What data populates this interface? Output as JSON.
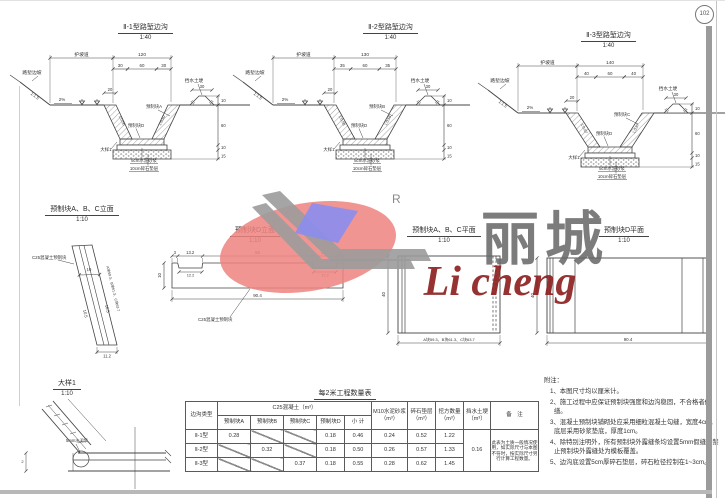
{
  "page": {
    "badge": "102"
  },
  "watermark": {
    "cn": "丽城",
    "en": "Li cheng",
    "r": "R"
  },
  "sections": {
    "s1": {
      "title": "Ⅱ-1型路堑边沟",
      "scale": "1:40",
      "total": "120",
      "sub": [
        "30",
        "60",
        "30"
      ],
      "berm": "护坡道",
      "cut": "路堑边坡",
      "slope": "1:1.5",
      "grade": "2%",
      "cap": "20",
      "slope_in": "1:0.50",
      "block_side": "预制块A",
      "block_bottom": "预制块D",
      "detail": "大样1",
      "mortar": "5cm水泥砂浆",
      "cushion": "10cm碎石垫层",
      "bank": "挡水土埂",
      "bank_w": "30",
      "bank_slope": "1:1",
      "vdims": [
        "10",
        "60",
        "10",
        "15"
      ]
    },
    "s2": {
      "title": "Ⅱ-2型路堑边沟",
      "scale": "1:40",
      "total": "130",
      "sub": [
        "35",
        "60",
        "35"
      ],
      "berm": "护坡道",
      "cut": "路堑边坡",
      "slope": "1:1.5",
      "grade": "2%",
      "cap": "20",
      "slope_in": "1:0.58",
      "block_side": "预制块B",
      "block_bottom": "预制块D",
      "detail": "大样1",
      "mortar": "5cm水泥砂浆",
      "cushion": "10cm碎石垫层",
      "bank": "挡水土埂",
      "bank_w": "30",
      "bank_slope": "1:1",
      "vdims": [
        "10",
        "60",
        "10",
        "15"
      ]
    },
    "s3": {
      "title": "Ⅱ-3型路堑边沟",
      "scale": "1:40",
      "total": "140",
      "sub": [
        "40",
        "60",
        "40"
      ],
      "berm": "护坡道",
      "cut": "路堑边坡",
      "slope": "1:1.5",
      "grade": "2%",
      "cap": "20",
      "slope_in": "1:0.67",
      "block_side": "预制块C",
      "block_bottom": "预制块D",
      "detail": "大样1",
      "mortar": "5cm水泥砂浆",
      "cushion": "10cm碎石垫层",
      "bank": "挡水土埂",
      "bank_w": "30",
      "bank_slope": "1:1",
      "vdims": [
        "10",
        "60",
        "10",
        "15"
      ]
    }
  },
  "elev_abc": {
    "title": "预制块A、B、C立面",
    "scale": "1:10",
    "material": "C25混凝土预制块",
    "dim_w": "10",
    "dim_s1": "10.5",
    "dim_s2": "10.5",
    "dim_b": "11.2",
    "lengths": "A块59.3、B块61.3、C块63.7"
  },
  "elev_d": {
    "title": "预制块D立面",
    "scale": "1:10",
    "material": "C25混凝土预制块",
    "dims_top": [
      "3",
      "13.2",
      "58",
      "13.2",
      "3"
    ],
    "dim_notch": "12.2",
    "dim_notch2": "12.2",
    "dim_small": "2",
    "dim_h": "10",
    "dim_b": "90.4"
  },
  "plan_abc": {
    "title": "预制块A、B、C平面",
    "scale": "1:10",
    "dim_h": "40",
    "dim_b": "A块59.3、B块61.3、C块63.7"
  },
  "plan_d": {
    "title": "预制块D平面",
    "scale": "1:10",
    "dim_h": "40",
    "dim_b": "90.4"
  },
  "detail1": {
    "title": "大样1",
    "scale": "1:10",
    "label": "5mm水泥浆",
    "dim": "2"
  },
  "table": {
    "title": "每2米工程数量表",
    "col_type": "边沟类型",
    "group_c25": "C25混凝土（m³）",
    "sub": [
      "预制块A",
      "预制块B",
      "预制块C",
      "预制块D",
      "小 计"
    ],
    "col_m10": "M10水泥砂浆",
    "col_m10_u": "（m³）",
    "col_cushion": "碎石垫层",
    "col_cushion_u": "（m³）",
    "col_excav": "挖方数量",
    "col_excav_u": "（m³）",
    "col_bank": "挡水土埂",
    "col_bank_u": "（m³）",
    "col_remark": "备　注",
    "rows": [
      {
        "type": "Ⅱ-1型",
        "a": "0.28",
        "b": "",
        "c": "",
        "d": "0.18",
        "sum": "0.46",
        "m10": "0.24",
        "cushion": "0.52",
        "excav": "1.22"
      },
      {
        "type": "Ⅱ-2型",
        "a": "",
        "b": "0.32",
        "c": "",
        "d": "0.18",
        "sum": "0.50",
        "m10": "0.26",
        "cushion": "0.57",
        "excav": "1.33"
      },
      {
        "type": "Ⅱ-3型",
        "a": "",
        "b": "",
        "c": "0.37",
        "d": "0.18",
        "sum": "0.55",
        "m10": "0.28",
        "cushion": "0.62",
        "excav": "1.45"
      }
    ],
    "bank_value": "0.16",
    "remark": "此表为土质一般情况使用，如实际尺寸与本图不符时，按实际尺寸另行计算工程数量。"
  },
  "notes": {
    "title": "附注：",
    "items": [
      "1、本图尺寸均以厘米计。",
      "2、施工过程中应保证预制块强度和边沟稳固，不合格者修缮。",
      "3、混凝土预制块铺砌处应采用细粒混凝土勾缝，宽度4cm，底层采用砂浆垫底，厚度1cm。",
      "4、除特别注明外，所有预制块外露缝条均设置5mm假缝，禁止预制块外露缝处为模板覆盖。",
      "5、边沟底设置5cm厚碎石垫层，碎石粒径控制在1~3cm。"
    ]
  }
}
